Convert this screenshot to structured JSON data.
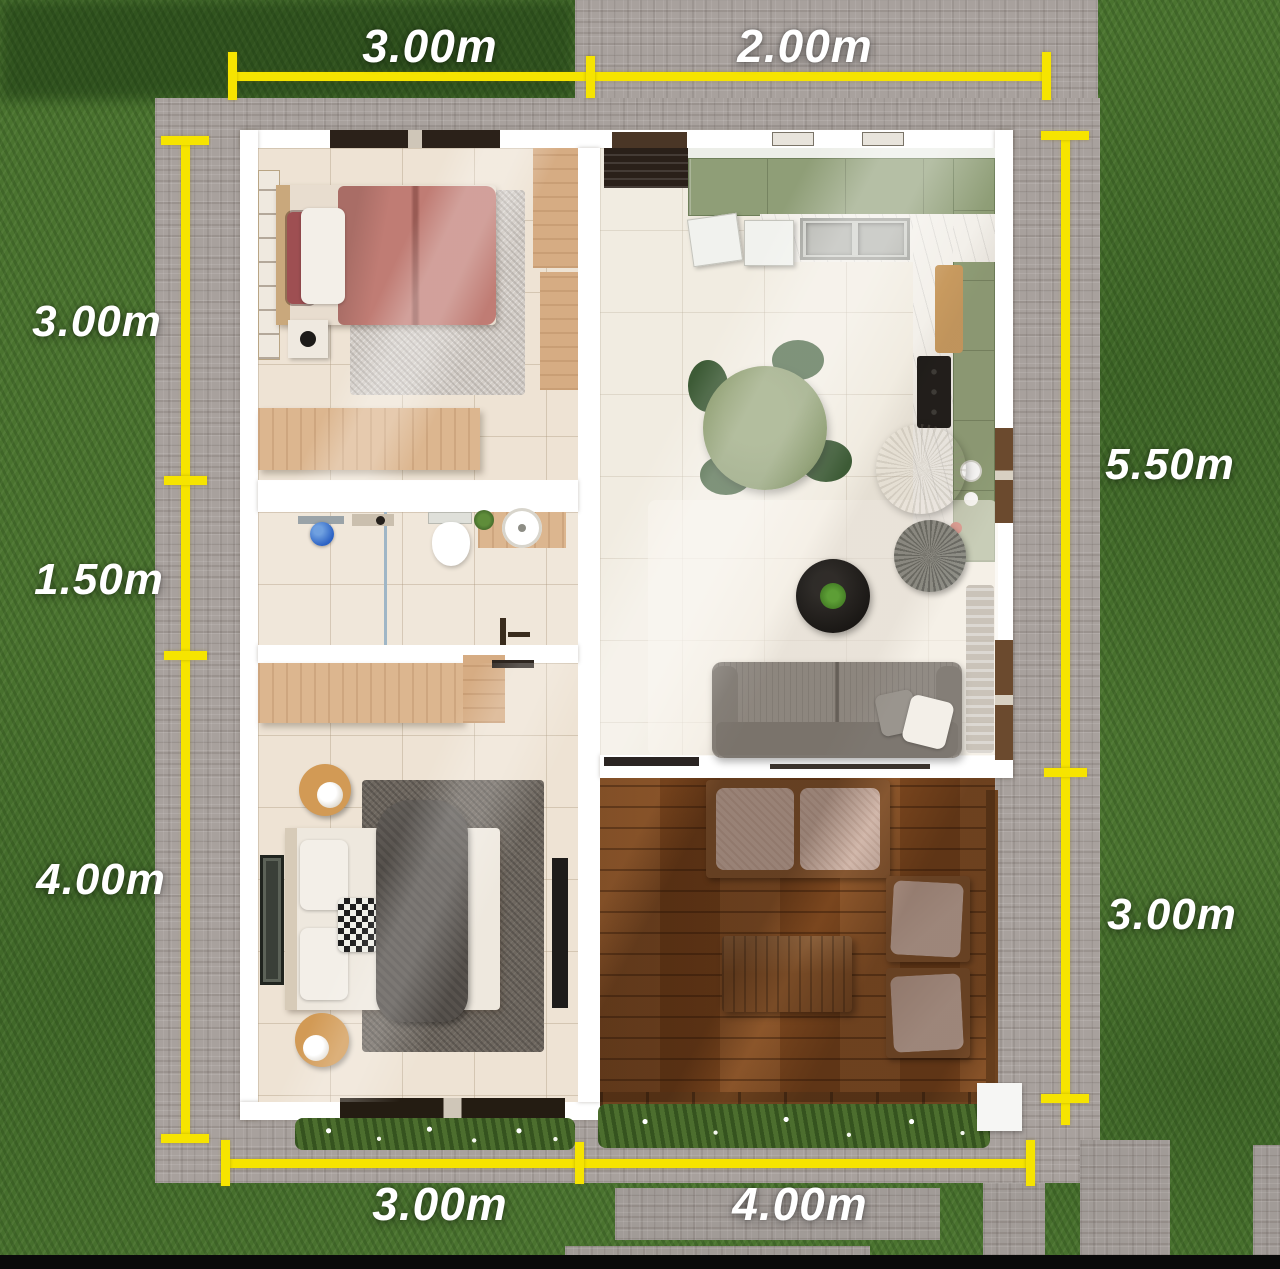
{
  "scene": {
    "kind": "top-view 3D floor plan render",
    "accent_color": "#f6e400",
    "label_color": "#ffffff",
    "grass_color": "#4a732f",
    "pavement_color": "#a8a19d",
    "deck_color": "#8a5023"
  },
  "dims": {
    "top": [
      "3.00m",
      "2.00m"
    ],
    "left": [
      "3.00m",
      "1.50m",
      "4.00m"
    ],
    "right": [
      "5.50m",
      "3.00m"
    ],
    "bottom": [
      "3.00m",
      "4.00m"
    ]
  }
}
